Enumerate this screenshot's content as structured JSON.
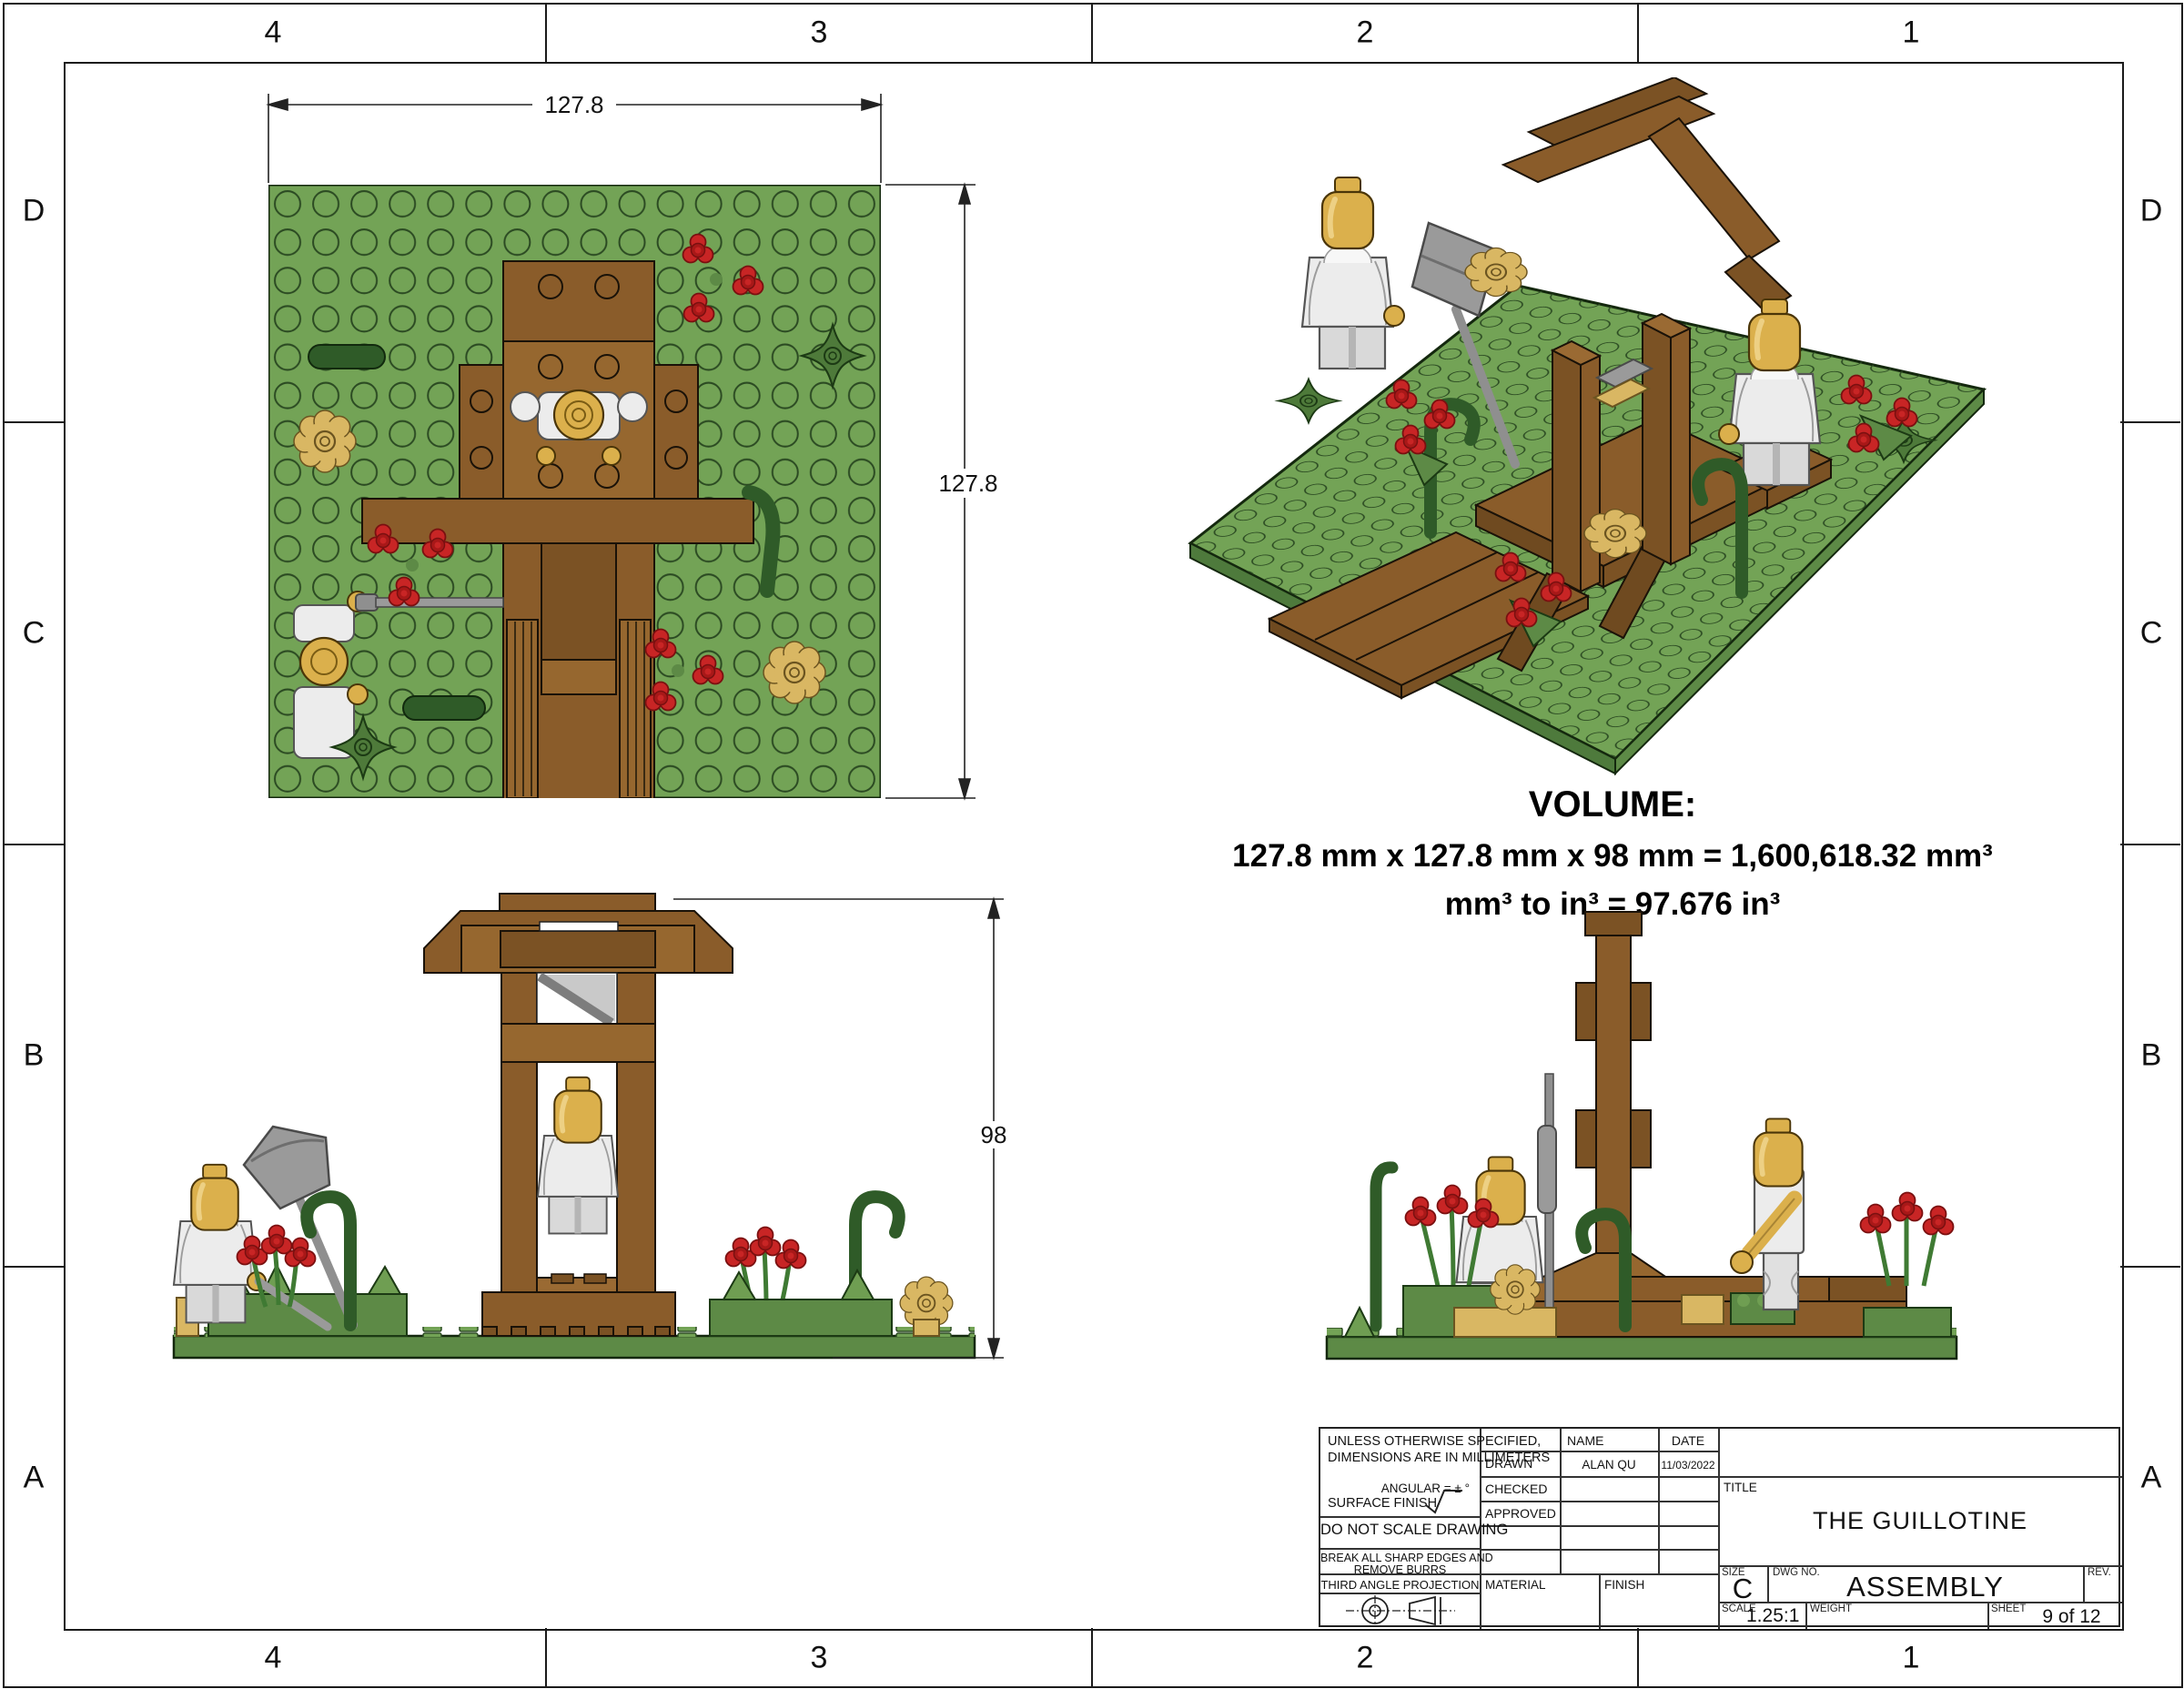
{
  "frame": {
    "cols": [
      "4",
      "3",
      "2",
      "1"
    ],
    "rows": [
      "D",
      "C",
      "B",
      "A"
    ]
  },
  "dimensions": {
    "top_width": "127.8",
    "top_height": "127.8",
    "front_height": "98"
  },
  "volume": {
    "heading": "VOLUME:",
    "line1": "127.8 mm x 127.8 mm x 98 mm = 1,600,618.32 mm³",
    "line2": "mm³ to in³ = 97.676 in³"
  },
  "title_block": {
    "notes": {
      "line1": "UNLESS OTHERWISE SPECIFIED,",
      "line2": "DIMENSIONS ARE IN MILLIMETERS",
      "angular": "ANGULAR = ± °",
      "surface_finish": "SURFACE FINISH",
      "do_not_scale": "DO NOT SCALE DRAWING",
      "break_edges_1": "BREAK ALL SHARP EDGES AND",
      "break_edges_2": "REMOVE BURRS",
      "projection": "THIRD ANGLE PROJECTION"
    },
    "approvals": {
      "name_header": "NAME",
      "date_header": "DATE",
      "rows": [
        {
          "label": "DRAWN",
          "name": "ALAN QU",
          "date": "11/03/2022"
        },
        {
          "label": "CHECKED",
          "name": "",
          "date": ""
        },
        {
          "label": "APPROVED",
          "name": "",
          "date": ""
        }
      ],
      "material_label": "MATERIAL",
      "finish_label": "FINISH"
    },
    "title_label": "TITLE",
    "title": "THE GUILLOTINE",
    "size_label": "SIZE",
    "size": "C",
    "dwg_label": "DWG NO.",
    "dwg_no": "ASSEMBLY",
    "rev_label": "REV.",
    "scale_label": "SCALE",
    "scale": "1.25:1",
    "weight_label": "WEIGHT",
    "sheet_label": "SHEET",
    "sheet": "9 of 12"
  }
}
